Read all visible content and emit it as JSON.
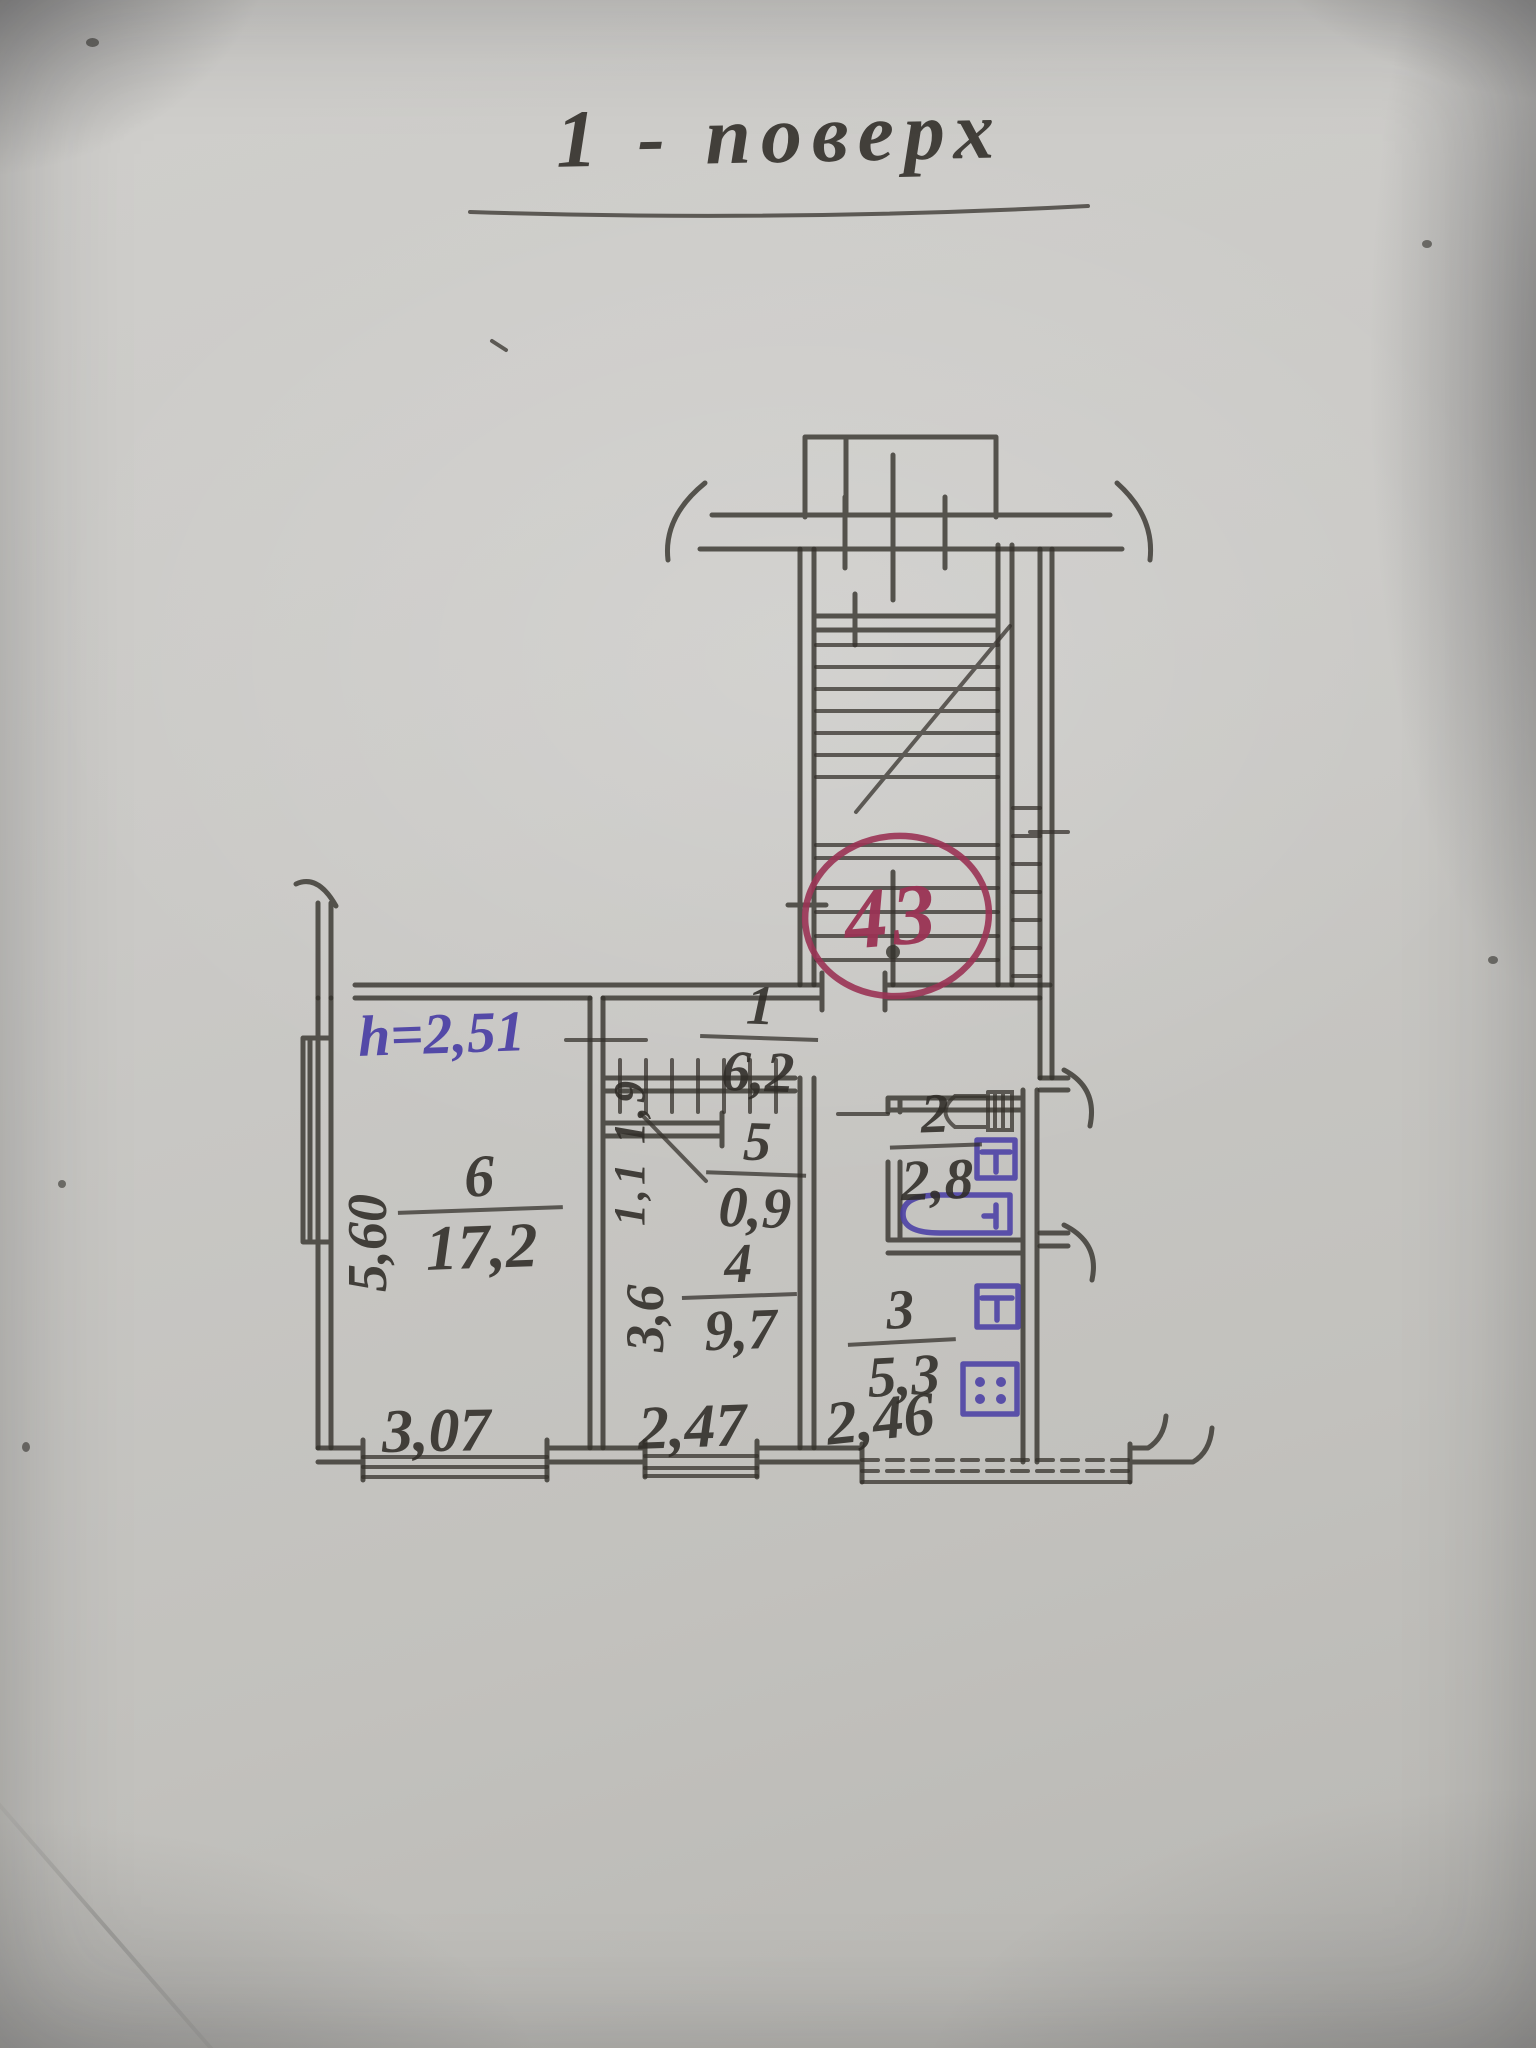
{
  "plan": {
    "title": "1 - поверх",
    "unit_number": "43",
    "height_note": "h=2,51",
    "rooms": [
      {
        "number": "1",
        "area": "6,2"
      },
      {
        "number": "2",
        "area": "2,8"
      },
      {
        "number": "3",
        "area": "5,3"
      },
      {
        "number": "4",
        "area": "9,7"
      },
      {
        "number": "5",
        "area": "0,9"
      },
      {
        "number": "6",
        "area": "17,2"
      }
    ],
    "dimensions": {
      "bottom": [
        "3,07",
        "2,47",
        "2,46"
      ],
      "left_wall": "5,60",
      "room4_depth": "3,6",
      "closet": "1,1 1,9"
    },
    "colors": {
      "pencil": "#2f2c27",
      "ink_blue": "#4a3fa5",
      "ink_red": "#9a3354",
      "paper": "#c9c8c4"
    }
  }
}
